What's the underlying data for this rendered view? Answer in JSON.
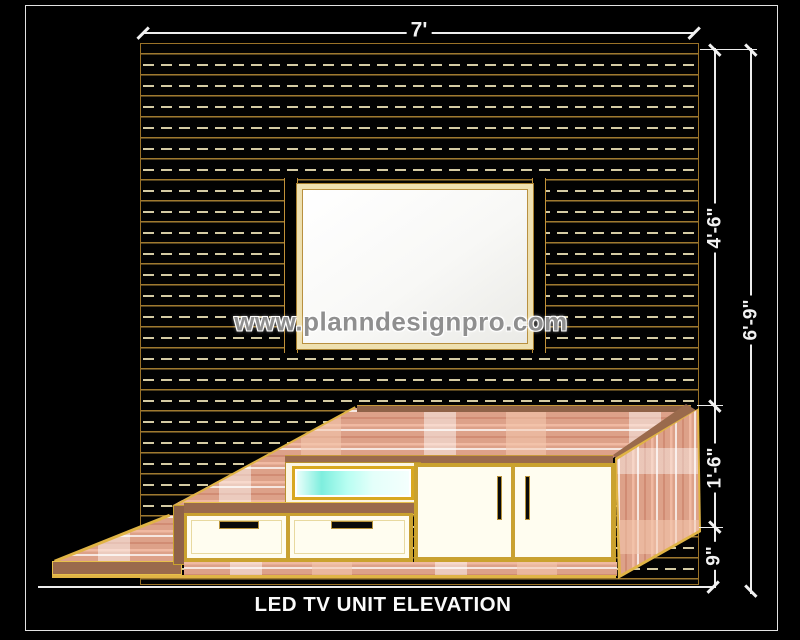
{
  "drawing": {
    "title": "LED TV UNIT ELEVATION",
    "watermark": "www.planndesignpro.com",
    "dimensions": {
      "panel_width": "7'",
      "panel_height": "4'-6\"",
      "total_height": "6'-9\"",
      "unit_height": "1'-6\"",
      "base_height": "9\""
    },
    "colors": {
      "background": "#000000",
      "border_white": "#e2e2e2",
      "panel_line_gold": "#9a7228",
      "panel_dash_cream": "#d5cba3",
      "cabinet_gold": "#e0b445",
      "wood_salmon": "#dda189",
      "wood_brown": "#9a6a4c",
      "glass_cyan": "#7eeede",
      "watermark_gray": "#8f8f8f"
    },
    "panel": {
      "dash_row_count": 25,
      "dash_row_start": 19.5,
      "dash_row_pitch": 21
    }
  }
}
